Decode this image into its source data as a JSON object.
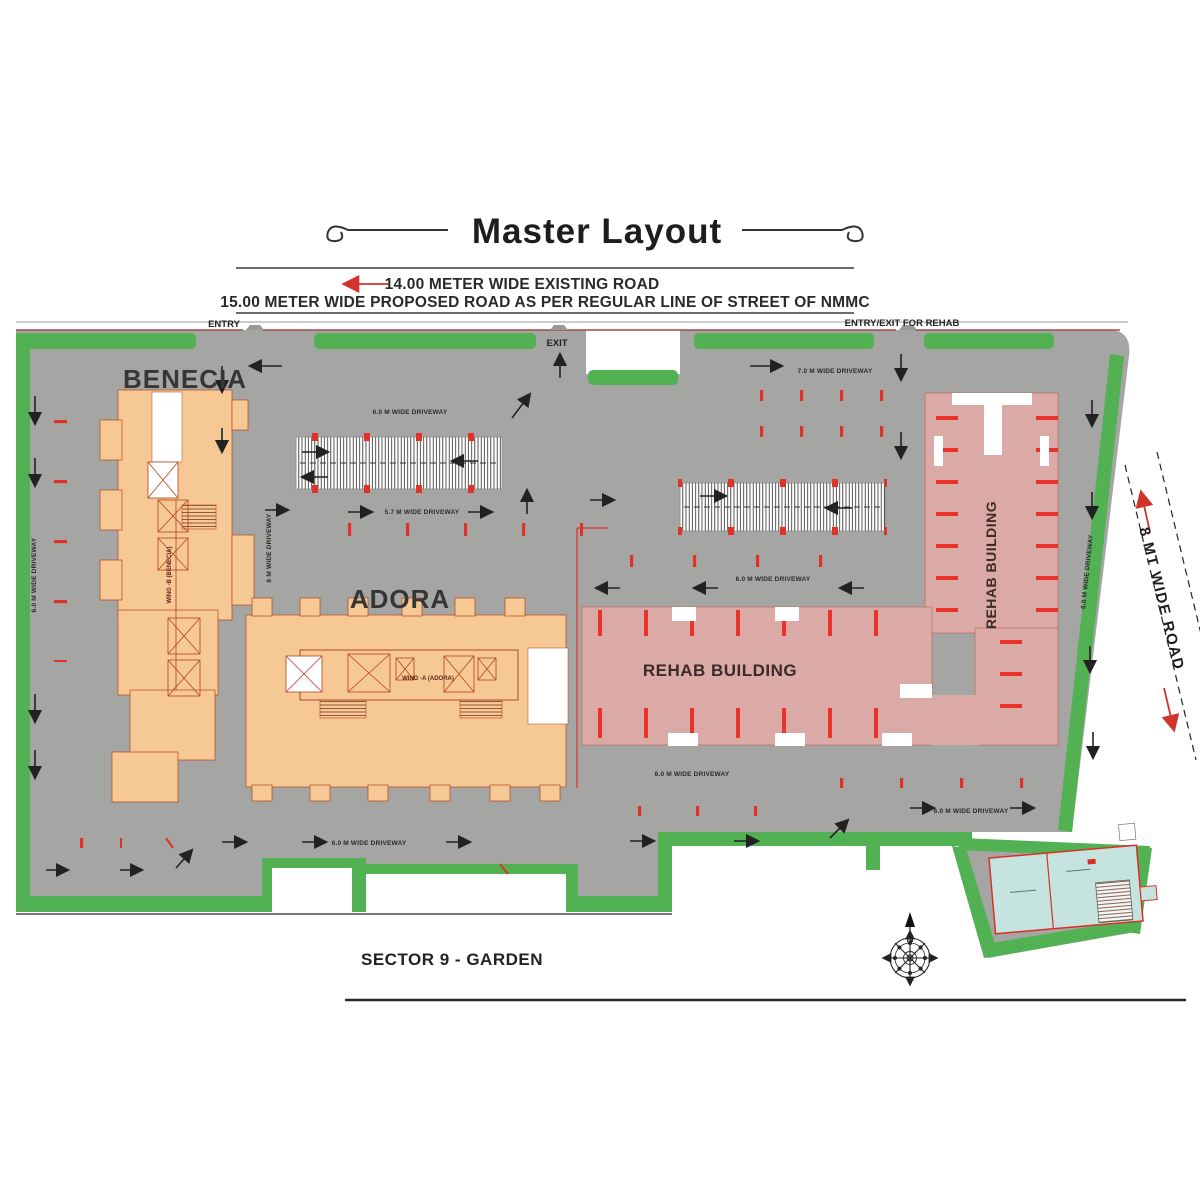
{
  "colors": {
    "site_gray": "#a5a6a3",
    "landscape_green": "#52b153",
    "building_orange": "#f6c893",
    "rehab_pink": "#dbaaa6",
    "amenity_teal": "#c5e4e0",
    "accent_red": "#e03228",
    "boundary_brown": "#9b4f4a",
    "ink": "#2d2d2d"
  },
  "header": {
    "title": "Master Layout",
    "road_note_1": "14.00 METER WIDE EXISTING ROAD",
    "road_note_2": "15.00 METER WIDE PROPOSED ROAD AS PER REGULAR LINE OF STREET OF NMMC"
  },
  "site": {
    "entry_label": "ENTRY",
    "exit_label": "EXIT",
    "rehab_entry_label": "ENTRY/EXIT FOR REHAB",
    "side_road_label": "8 MT WIDE ROAD",
    "sector_label": "SECTOR 9 - GARDEN",
    "compass_north": "N",
    "buildings": {
      "benecia": {
        "label": "BENECIA",
        "wing_label": "WING -B (BENECIA)"
      },
      "adora": {
        "label": "ADORA",
        "wing_label": "WING -A (ADORA)"
      },
      "rehab_main": {
        "label": "REHAB BUILDING"
      },
      "rehab_tower": {
        "label": "REHAB BUILDING"
      }
    },
    "driveway_labels": [
      {
        "text": "6.0 M WIDE DRIVEWAY"
      },
      {
        "text": "7.0 M WIDE DRIVEWAY"
      },
      {
        "text": "5.7 M WIDE DRIVEWAY"
      },
      {
        "text": "6.0 M WIDE DRIVEWAY"
      },
      {
        "text": "6.0 M WIDE DRIVEWAY"
      },
      {
        "text": "6.0 M WIDE DRIVEWAY"
      },
      {
        "text": "6.0 M WIDE DRIVEWAY"
      },
      {
        "text": "6.0 M WIDE DRIVEWAY"
      },
      {
        "text": "6 M WIDE DRIVEWAY"
      },
      {
        "text": "6.0 M WIDE DRIVEWAY"
      }
    ]
  }
}
